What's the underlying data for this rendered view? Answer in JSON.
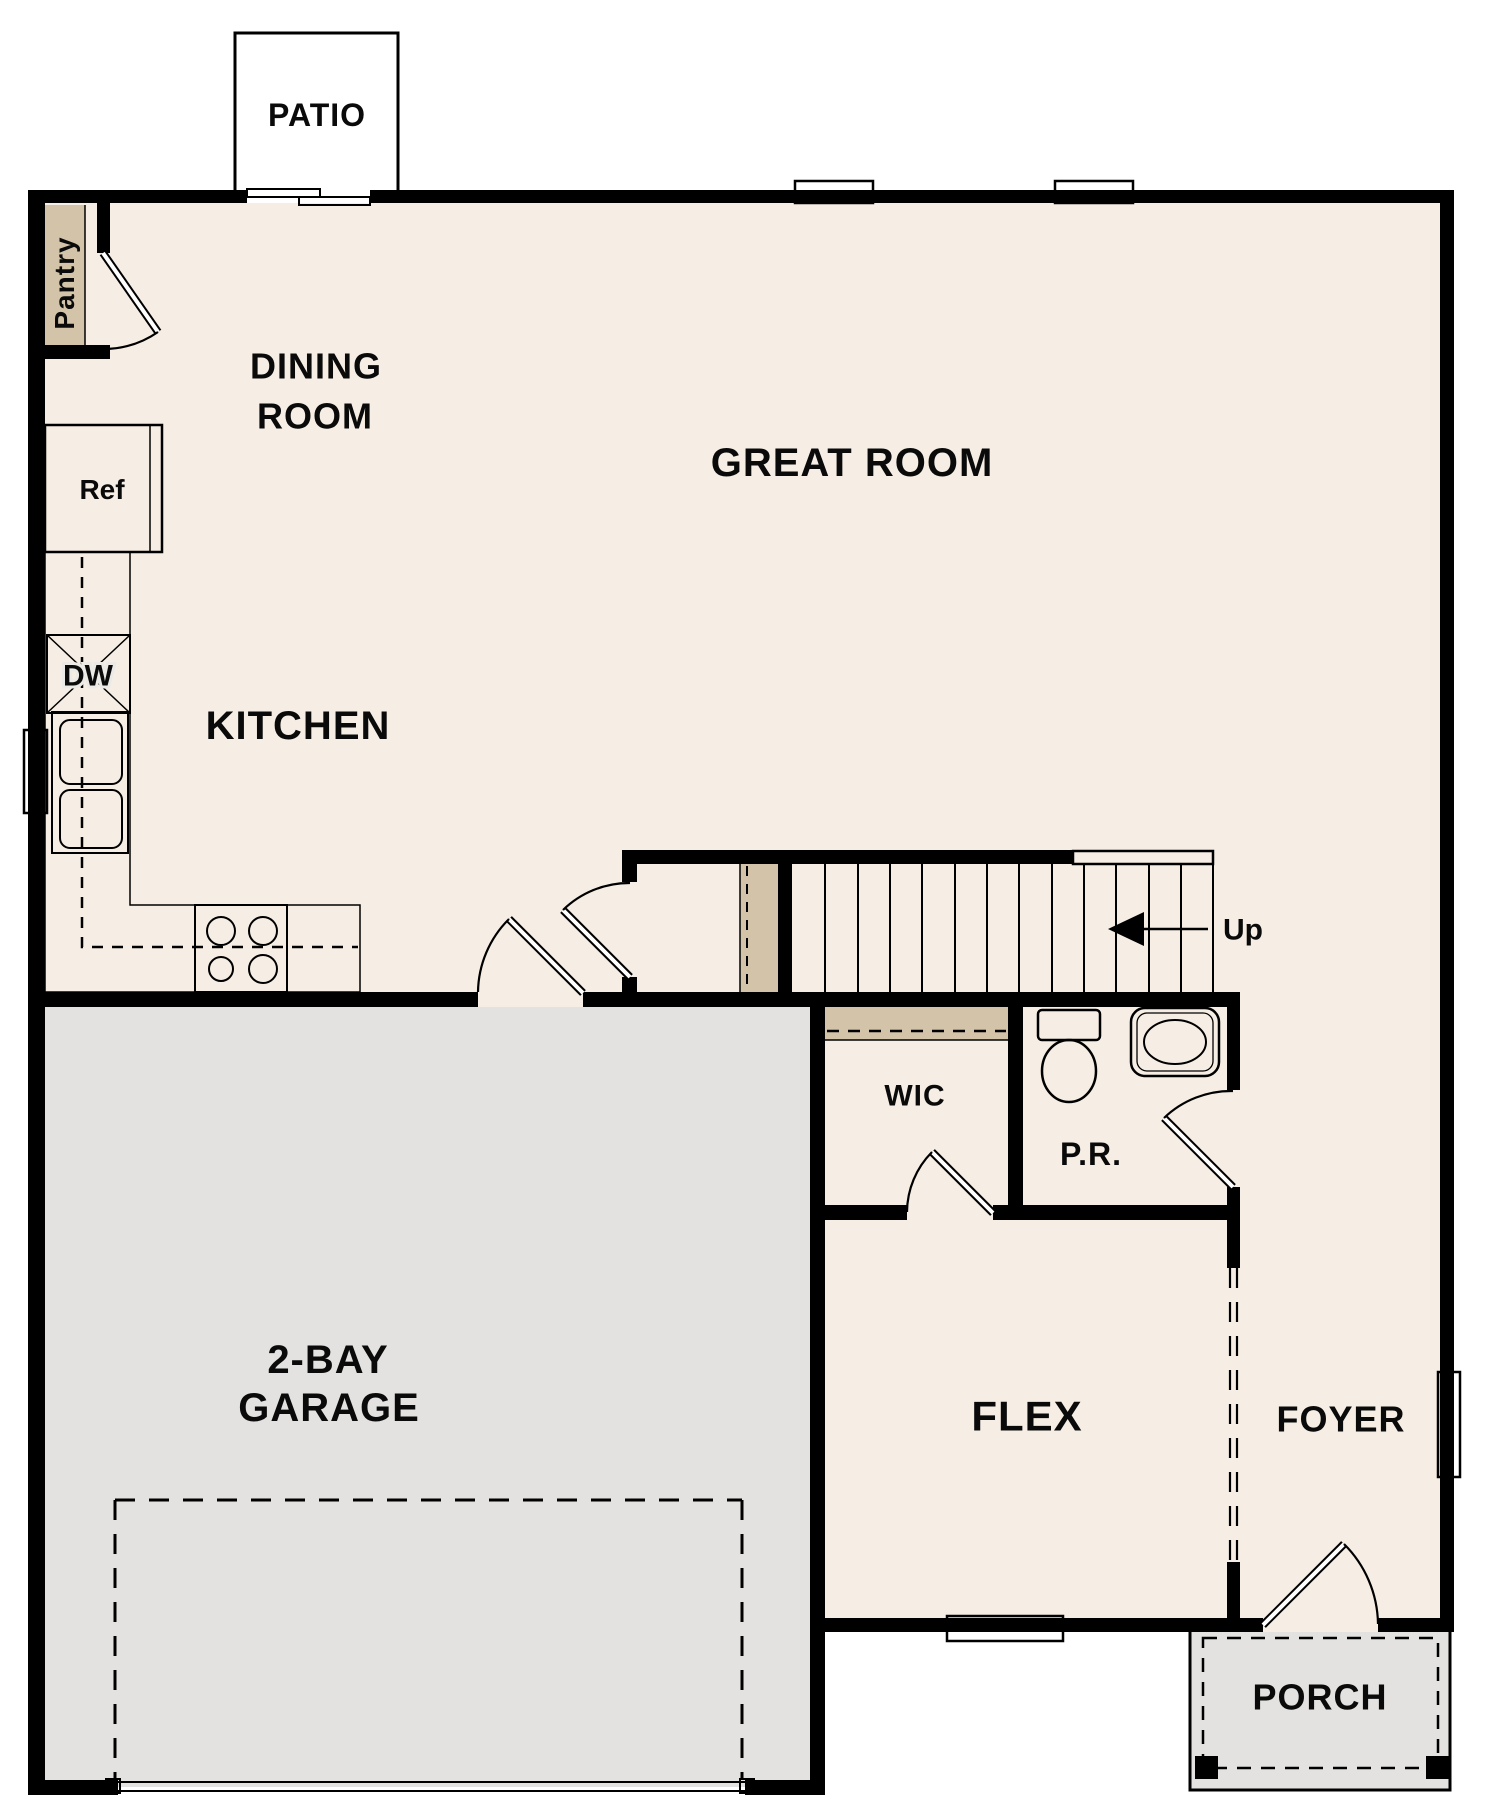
{
  "title": "First floor plan",
  "colors": {
    "wall": "#000000",
    "floor": "#f6eee4",
    "gray-floor": "#e3e2e0",
    "counter": "#d2c3a9",
    "fixture": "#e0dfdd",
    "sink-blue": "#aac9e9",
    "background": "#ffffff"
  },
  "labels": {
    "patio": "PATIO",
    "pantry": "Pantry",
    "dining_line1": "DINING",
    "dining_line2": "ROOM",
    "great_room": "GREAT ROOM",
    "kitchen": "KITCHEN",
    "ref": "Ref",
    "dw": "DW",
    "up": "Up",
    "wic": "WIC",
    "powder_room": "P.R.",
    "garage_line1": "2-BAY",
    "garage_line2": "GARAGE",
    "flex": "FLEX",
    "foyer": "FOYER",
    "porch": "PORCH"
  }
}
